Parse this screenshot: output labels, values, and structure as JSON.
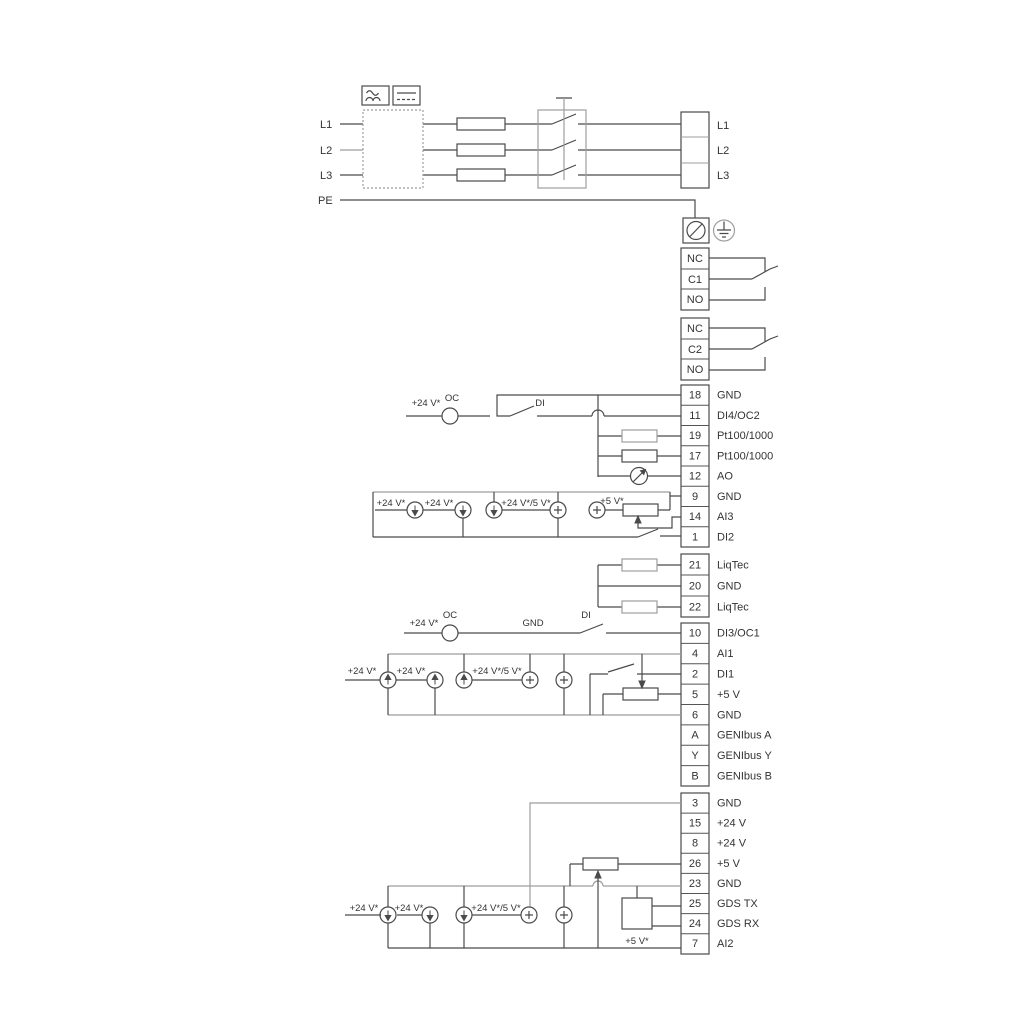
{
  "diagram": {
    "input": {
      "l1": "L1",
      "l2": "L2",
      "l3": "L3",
      "pe": "PE"
    },
    "output": {
      "l1": "L1",
      "l2": "L2",
      "l3": "L3"
    },
    "relay1": {
      "nc": "NC",
      "c": "C1",
      "no": "NO"
    },
    "relay2": {
      "nc": "NC",
      "c": "C2",
      "no": "NO"
    },
    "groupA": [
      {
        "no": "18",
        "label": "GND"
      },
      {
        "no": "11",
        "label": "DI4/OC2"
      },
      {
        "no": "19",
        "label": "Pt100/1000"
      },
      {
        "no": "17",
        "label": "Pt100/1000"
      },
      {
        "no": "12",
        "label": "AO"
      },
      {
        "no": "9",
        "label": "GND"
      },
      {
        "no": "14",
        "label": "AI3"
      },
      {
        "no": "1",
        "label": "DI2"
      }
    ],
    "groupB": [
      {
        "no": "21",
        "label": "LiqTec"
      },
      {
        "no": "20",
        "label": "GND"
      },
      {
        "no": "22",
        "label": "LiqTec"
      }
    ],
    "groupC": [
      {
        "no": "10",
        "label": "DI3/OC1"
      },
      {
        "no": "4",
        "label": "AI1"
      },
      {
        "no": "2",
        "label": "DI1"
      },
      {
        "no": "5",
        "label": "+5 V"
      },
      {
        "no": "6",
        "label": "GND"
      },
      {
        "no": "A",
        "label": "GENIbus A"
      },
      {
        "no": "Y",
        "label": "GENIbus Y"
      },
      {
        "no": "B",
        "label": "GENIbus B"
      }
    ],
    "groupD": [
      {
        "no": "3",
        "label": "GND"
      },
      {
        "no": "15",
        "label": "+24 V"
      },
      {
        "no": "8",
        "label": "+24 V"
      },
      {
        "no": "26",
        "label": "+5 V"
      },
      {
        "no": "23",
        "label": "GND"
      },
      {
        "no": "25",
        "label": "GDS TX"
      },
      {
        "no": "24",
        "label": "GDS RX"
      },
      {
        "no": "7",
        "label": "AI2"
      }
    ],
    "ann": {
      "rowA": {
        "supply": "+24 V*",
        "oc": "OC",
        "di": "DI"
      },
      "row1": {
        "v24a": "+24 V*",
        "v24b": "+24 V*",
        "v245": "+24 V*/5 V*",
        "v5": "+5 V*"
      },
      "rowC": {
        "supply": "+24 V*",
        "oc": "OC",
        "gnd": "GND",
        "di": "DI"
      },
      "row2": {
        "v24a": "+24 V*",
        "v24b": "+24 V*",
        "v245": "+24 V*/5 V*"
      },
      "row3": {
        "v24a": "+24 V*",
        "v24b": "+24 V*",
        "v245": "+24 V*/5 V*",
        "v5": "+5 V*"
      }
    },
    "colors": {
      "wire": "#4a4a4a",
      "wire_gray": "#9e9e9e",
      "text": "#333333",
      "bg": "#ffffff"
    }
  }
}
